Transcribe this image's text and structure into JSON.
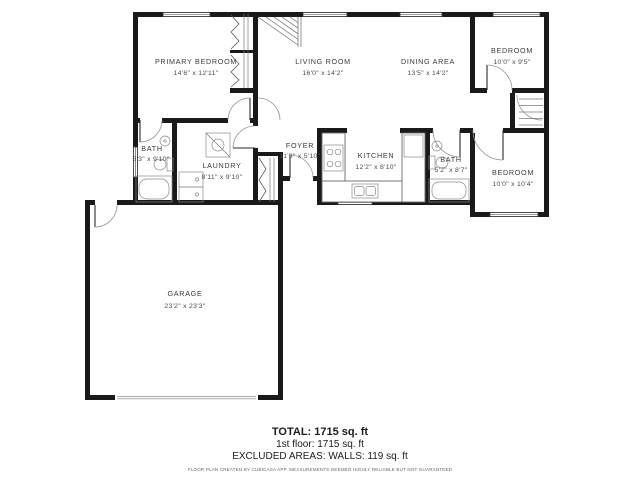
{
  "floor_plan": {
    "rooms": [
      {
        "id": "primary-bedroom",
        "name": "PRIMARY BEDROOM",
        "dims": "14'6\" x 12'11\""
      },
      {
        "id": "living-room",
        "name": "LIVING ROOM",
        "dims": "16'0\" x 14'2\""
      },
      {
        "id": "dining-area",
        "name": "DINING AREA",
        "dims": "13'5\" x 14'2\""
      },
      {
        "id": "bedroom-top-right",
        "name": "BEDROOM",
        "dims": "10'0\" x 9'5\""
      },
      {
        "id": "bath-left",
        "name": "BATH",
        "dims": "5'3\" x 9'10\""
      },
      {
        "id": "laundry",
        "name": "LAUNDRY",
        "dims": "8'11\" x 9'10\""
      },
      {
        "id": "foyer",
        "name": "FOYER",
        "dims": "11'9\" x 5'10\""
      },
      {
        "id": "kitchen",
        "name": "KITCHEN",
        "dims": "12'2\" x 8'10\""
      },
      {
        "id": "bath-right",
        "name": "BATH",
        "dims": "5'2\" x 8'7\""
      },
      {
        "id": "bedroom-bottom-right",
        "name": "BEDROOM",
        "dims": "10'0\" x 10'4\""
      },
      {
        "id": "garage",
        "name": "GARAGE",
        "dims": "23'2\" x 23'3\""
      }
    ],
    "summary": {
      "total": "TOTAL: 1715 sq. ft",
      "first_floor": "1st floor: 1715 sq. ft",
      "excluded": "EXCLUDED AREAS: WALLS: 119 sq. ft",
      "disclaimer": "FLOOR PLAN CREATED BY CUBICASA APP. MEASUREMENTS DEEMED HIGHLY RELIABLE BUT NOT GUARANTEED"
    },
    "colors": {
      "wall": "#1a1a1a",
      "background": "#ffffff",
      "label": "#3a3a3a"
    }
  }
}
